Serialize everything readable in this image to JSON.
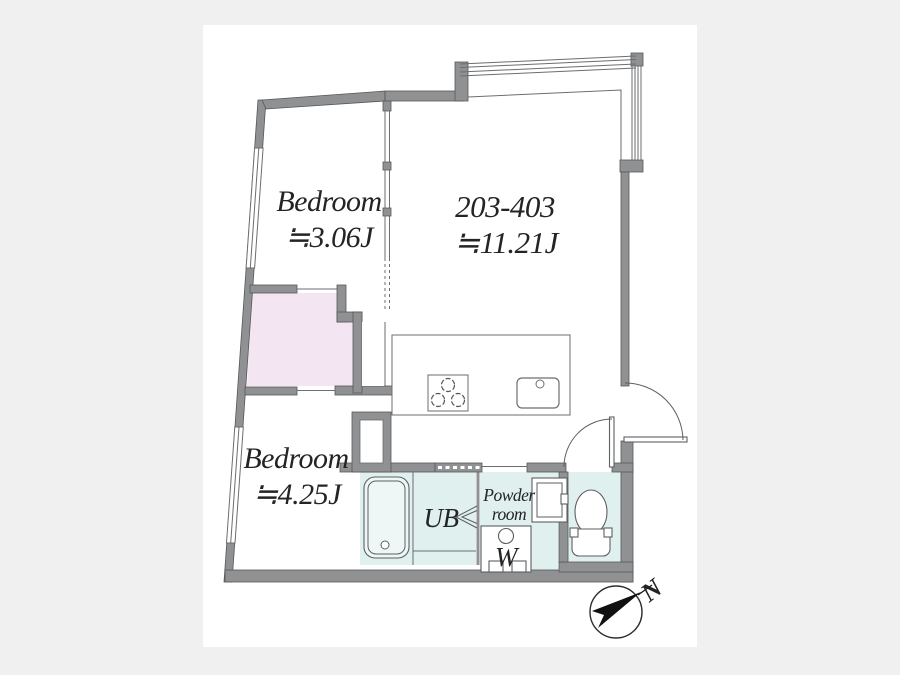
{
  "page": {
    "background_color": "#f0f0f0",
    "panel_color": "#ffffff"
  },
  "colors": {
    "wall": "#8f9193",
    "wet_area": "#dff0ef",
    "closet": "#f4e5f3",
    "line": "#6b6d70",
    "text": "#242424"
  },
  "rooms": {
    "bedroom_upper": {
      "name": "Bedroom",
      "area": "≒3.06J"
    },
    "living": {
      "name": "203-403",
      "area": "≒11.21J"
    },
    "bedroom_lower": {
      "name": "Bedroom",
      "area": "≒4.25J"
    },
    "bath": {
      "label": "UB"
    },
    "powder_room": {
      "label_line1": "Powder",
      "label_line2": "room"
    },
    "washer": {
      "label": "W"
    }
  },
  "compass": {
    "north_label": "N"
  }
}
